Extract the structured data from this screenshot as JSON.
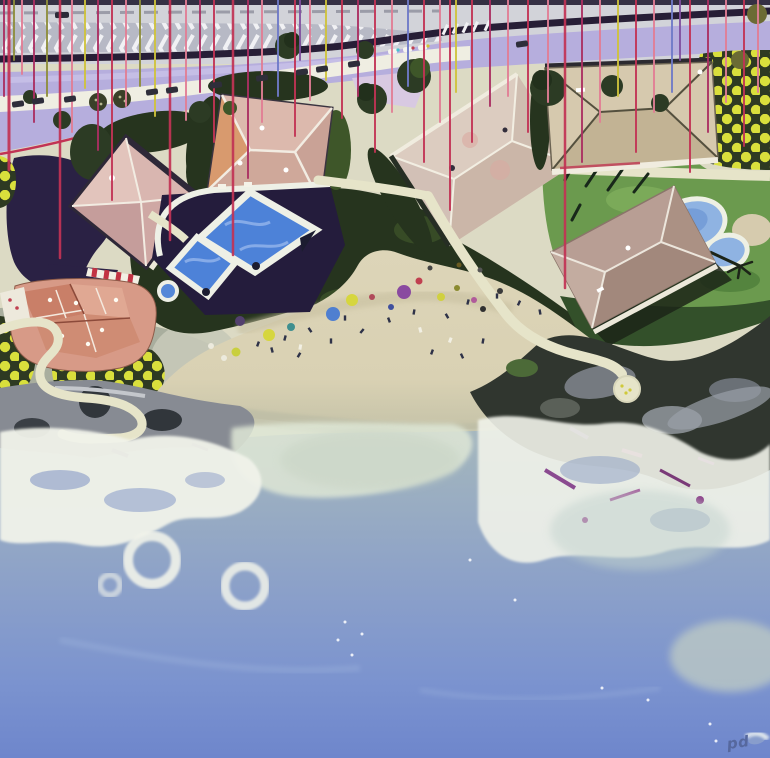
{
  "artwork": {
    "signature": "pd"
  },
  "palette": {
    "top_strip": "#353044",
    "road_gray": "#d2d3d9",
    "road_dash": "#9b9ca8",
    "chev_bg": "#b7b9c5",
    "chev_white": "#f1f1f4",
    "median_dark": "#271e36",
    "lavender": "#b6aedd",
    "lavender_light": "#c9c2e8",
    "lavender_pink": "#d8c9e2",
    "edge_crimson": "#c23355",
    "cream": "#e6e4c9",
    "cream_dark": "#d8d6ba",
    "parking_white": "#efeee2",
    "ground_olive": "#dcdac4",
    "tree_dark": "#26341e",
    "tree_mid": "#3e5629",
    "lawn": "#6b9a4e",
    "lawn_light": "#7fae5c",
    "polka_bg": "#2e3a22",
    "polka_dot": "#d9df3c",
    "deck_navy": "#241c3c",
    "navy_shadow": "#2a2144",
    "pool_blue": "#4d82d8",
    "pool_light": "#86abe8",
    "pool_rim": "#eef0e6",
    "kidney_blue": "#8fb3e2",
    "kidney_deep": "#6f98d6",
    "roofA": "#d9b6b0",
    "roofA_sh": "#c59d9b",
    "roofB": "#dcb9ad",
    "roofB_sh": "#cfa89a",
    "roofB_or": "#d89a6e",
    "roofC": "#d8c7bb",
    "roofC_sh": "#cbb6a8",
    "roofD": "#d6c9ae",
    "roofD_sh": "#c2b394",
    "roofE": "#b89e94",
    "roofE_sh": "#a2887c",
    "roofF": "#d79a87",
    "roofF_dk": "#c97f68",
    "sand": "#d9d1b3",
    "sand_wet": "#bdbda6",
    "rock_gray": "#878b93",
    "rock_dark": "#31363b",
    "cliff_dark": "#30362f",
    "cliff_gray": "#7d8289",
    "purple_accent": "#6a4a85",
    "magenta_accent": "#9c3f80",
    "ocean_top": "#b6c3bd",
    "ocean_mid": "#9fb2bf",
    "ocean_deep": "#7b93cf",
    "ocean_bottom": "#6e86cc",
    "foam_white": "#f1f3ea",
    "foam_soft": "#dfe7d6",
    "mint": "#c7d3c3",
    "teal_pale": "#c2d3cd",
    "signature_blue": "#56689e",
    "drip_crimson": "#c23355",
    "drip_pink": "#e27e95",
    "drip_magenta": "#ab2f62",
    "drip_yellow": "#cfc33c",
    "drip_olive": "#8e8e3c",
    "drip_blue": "#6f7ac8",
    "drip_violet": "#8050a0"
  },
  "scene": {
    "drips": [
      {
        "x": 4,
        "y1": 0,
        "y2": 96,
        "c": "drip_magenta",
        "w": 2
      },
      {
        "x": 9,
        "y1": 0,
        "y2": 170,
        "c": "drip_crimson",
        "w": 3
      },
      {
        "x": 14,
        "y1": 0,
        "y2": 60,
        "c": "drip_olive",
        "w": 2
      },
      {
        "x": 22,
        "y1": 0,
        "y2": 74,
        "c": "drip_pink",
        "w": 2
      },
      {
        "x": 34,
        "y1": 0,
        "y2": 122,
        "c": "drip_magenta",
        "w": 2
      },
      {
        "x": 47,
        "y1": 0,
        "y2": 96,
        "c": "drip_olive",
        "w": 2
      },
      {
        "x": 60,
        "y1": 0,
        "y2": 258,
        "c": "drip_crimson",
        "w": 2.5
      },
      {
        "x": 72,
        "y1": 0,
        "y2": 132,
        "c": "drip_pink",
        "w": 2
      },
      {
        "x": 85,
        "y1": 0,
        "y2": 88,
        "c": "drip_yellow",
        "w": 2
      },
      {
        "x": 98,
        "y1": 0,
        "y2": 150,
        "c": "drip_magenta",
        "w": 2
      },
      {
        "x": 112,
        "y1": 0,
        "y2": 200,
        "c": "drip_crimson",
        "w": 2
      },
      {
        "x": 126,
        "y1": 0,
        "y2": 106,
        "c": "drip_pink",
        "w": 2
      },
      {
        "x": 140,
        "y1": 0,
        "y2": 86,
        "c": "drip_olive",
        "w": 2
      },
      {
        "x": 155,
        "y1": 0,
        "y2": 116,
        "c": "drip_yellow",
        "w": 2
      },
      {
        "x": 170,
        "y1": 0,
        "y2": 240,
        "c": "drip_crimson",
        "w": 2.5
      },
      {
        "x": 186,
        "y1": 0,
        "y2": 120,
        "c": "drip_pink",
        "w": 2
      },
      {
        "x": 200,
        "y1": 0,
        "y2": 92,
        "c": "drip_magenta",
        "w": 2
      },
      {
        "x": 214,
        "y1": 0,
        "y2": 142,
        "c": "drip_crimson",
        "w": 2
      },
      {
        "x": 233,
        "y1": 0,
        "y2": 255,
        "c": "drip_crimson",
        "w": 2.5
      },
      {
        "x": 248,
        "y1": 0,
        "y2": 178,
        "c": "drip_magenta",
        "w": 2
      },
      {
        "x": 262,
        "y1": 0,
        "y2": 122,
        "c": "drip_pink",
        "w": 2
      },
      {
        "x": 278,
        "y1": 0,
        "y2": 96,
        "c": "drip_blue",
        "w": 2
      },
      {
        "x": 295,
        "y1": 0,
        "y2": 136,
        "c": "drip_crimson",
        "w": 2
      },
      {
        "x": 300,
        "y1": 0,
        "y2": 60,
        "c": "drip_violet",
        "w": 2
      },
      {
        "x": 310,
        "y1": 0,
        "y2": 100,
        "c": "drip_pink",
        "w": 2
      },
      {
        "x": 326,
        "y1": 0,
        "y2": 80,
        "c": "drip_yellow",
        "w": 2
      },
      {
        "x": 342,
        "y1": 0,
        "y2": 118,
        "c": "drip_crimson",
        "w": 2
      },
      {
        "x": 358,
        "y1": 0,
        "y2": 96,
        "c": "drip_magenta",
        "w": 2
      },
      {
        "x": 375,
        "y1": 0,
        "y2": 152,
        "c": "drip_crimson",
        "w": 2
      },
      {
        "x": 392,
        "y1": 0,
        "y2": 112,
        "c": "drip_pink",
        "w": 2
      },
      {
        "x": 408,
        "y1": 0,
        "y2": 86,
        "c": "drip_blue",
        "w": 2
      },
      {
        "x": 424,
        "y1": 0,
        "y2": 162,
        "c": "drip_crimson",
        "w": 2
      },
      {
        "x": 440,
        "y1": 0,
        "y2": 122,
        "c": "drip_pink",
        "w": 2
      },
      {
        "x": 450,
        "y1": 0,
        "y2": 210,
        "c": "drip_crimson",
        "w": 2
      },
      {
        "x": 456,
        "y1": 0,
        "y2": 92,
        "c": "drip_yellow",
        "w": 2
      },
      {
        "x": 472,
        "y1": 0,
        "y2": 142,
        "c": "drip_crimson",
        "w": 2
      },
      {
        "x": 490,
        "y1": 0,
        "y2": 106,
        "c": "drip_magenta",
        "w": 2
      },
      {
        "x": 508,
        "y1": 0,
        "y2": 96,
        "c": "drip_pink",
        "w": 2
      },
      {
        "x": 528,
        "y1": 0,
        "y2": 132,
        "c": "drip_crimson",
        "w": 2
      },
      {
        "x": 548,
        "y1": 0,
        "y2": 102,
        "c": "drip_pink",
        "w": 2
      },
      {
        "x": 565,
        "y1": 0,
        "y2": 288,
        "c": "drip_crimson",
        "w": 2.5
      },
      {
        "x": 582,
        "y1": 0,
        "y2": 162,
        "c": "drip_magenta",
        "w": 2
      },
      {
        "x": 600,
        "y1": 0,
        "y2": 122,
        "c": "drip_pink",
        "w": 2
      },
      {
        "x": 618,
        "y1": 0,
        "y2": 96,
        "c": "drip_yellow",
        "w": 2
      },
      {
        "x": 636,
        "y1": 0,
        "y2": 152,
        "c": "drip_crimson",
        "w": 2
      },
      {
        "x": 654,
        "y1": 0,
        "y2": 112,
        "c": "drip_pink",
        "w": 2
      },
      {
        "x": 672,
        "y1": 0,
        "y2": 92,
        "c": "drip_blue",
        "w": 2
      },
      {
        "x": 680,
        "y1": 0,
        "y2": 60,
        "c": "drip_violet",
        "w": 2
      },
      {
        "x": 690,
        "y1": 0,
        "y2": 172,
        "c": "drip_crimson",
        "w": 2
      },
      {
        "x": 708,
        "y1": 0,
        "y2": 132,
        "c": "drip_magenta",
        "w": 2
      },
      {
        "x": 726,
        "y1": 0,
        "y2": 102,
        "c": "drip_pink",
        "w": 2
      },
      {
        "x": 744,
        "y1": 0,
        "y2": 146,
        "c": "drip_crimson",
        "w": 2
      },
      {
        "x": 758,
        "y1": 0,
        "y2": 92,
        "c": "drip_pink",
        "w": 2
      }
    ],
    "umbrellas": [
      {
        "x": 352,
        "y": 300,
        "r": 6,
        "c": "#d6d63e"
      },
      {
        "x": 333,
        "y": 314,
        "r": 7,
        "c": "#4f7fd0"
      },
      {
        "x": 404,
        "y": 292,
        "r": 7,
        "c": "#8a4aa0"
      },
      {
        "x": 419,
        "y": 281,
        "r": 3.5,
        "c": "#c04050"
      },
      {
        "x": 269,
        "y": 335,
        "r": 6,
        "c": "#d6d63e"
      },
      {
        "x": 240,
        "y": 321,
        "r": 5,
        "c": "#53406e"
      },
      {
        "x": 291,
        "y": 327,
        "r": 4,
        "c": "#3f8f8f"
      },
      {
        "x": 372,
        "y": 297,
        "r": 3,
        "c": "#b04a5a"
      },
      {
        "x": 391,
        "y": 307,
        "r": 3,
        "c": "#40509e"
      },
      {
        "x": 441,
        "y": 297,
        "r": 4,
        "c": "#d0d040"
      },
      {
        "x": 457,
        "y": 288,
        "r": 3,
        "c": "#8a8a30"
      },
      {
        "x": 474,
        "y": 300,
        "r": 3,
        "c": "#b05a9a"
      },
      {
        "x": 236,
        "y": 352,
        "r": 4.5,
        "c": "#c9cf3e"
      },
      {
        "x": 211,
        "y": 346,
        "r": 3,
        "c": "#eceadd"
      },
      {
        "x": 224,
        "y": 358,
        "r": 3,
        "c": "#eceadd"
      },
      {
        "x": 500,
        "y": 291,
        "r": 3,
        "c": "#3a3a3a"
      },
      {
        "x": 483,
        "y": 309,
        "r": 3,
        "c": "#2f2f2f"
      },
      {
        "x": 459,
        "y": 265,
        "r": 2.5,
        "c": "#6a5a20"
      },
      {
        "x": 430,
        "y": 268,
        "r": 2.5,
        "c": "#444444"
      },
      {
        "x": 480,
        "y": 270,
        "r": 2.5,
        "c": "#555555"
      }
    ],
    "people": [
      {
        "x": 258,
        "y": 344,
        "a": 20
      },
      {
        "x": 272,
        "y": 350,
        "a": -15
      },
      {
        "x": 299,
        "y": 355,
        "a": 30
      },
      {
        "x": 331,
        "y": 341,
        "a": 0
      },
      {
        "x": 362,
        "y": 331,
        "a": 40
      },
      {
        "x": 389,
        "y": 320,
        "a": -20
      },
      {
        "x": 414,
        "y": 312,
        "a": 10
      },
      {
        "x": 447,
        "y": 316,
        "a": -30
      },
      {
        "x": 468,
        "y": 302,
        "a": 15
      },
      {
        "x": 497,
        "y": 296,
        "a": 0
      },
      {
        "x": 519,
        "y": 303,
        "a": 25
      },
      {
        "x": 540,
        "y": 312,
        "a": -10
      },
      {
        "x": 432,
        "y": 352,
        "a": 20
      },
      {
        "x": 462,
        "y": 356,
        "a": -25
      },
      {
        "x": 483,
        "y": 341,
        "a": 10
      },
      {
        "x": 310,
        "y": 330,
        "a": -35
      },
      {
        "x": 285,
        "y": 338,
        "a": 15
      },
      {
        "x": 345,
        "y": 318,
        "a": 0
      },
      {
        "x": 300,
        "y": 347,
        "a": 10,
        "t": "w"
      },
      {
        "x": 420,
        "y": 330,
        "a": -15,
        "t": "w"
      },
      {
        "x": 450,
        "y": 340,
        "a": 20,
        "t": "w"
      }
    ],
    "cars": [
      {
        "x": 18,
        "y": 104
      },
      {
        "x": 38,
        "y": 101
      },
      {
        "x": 70,
        "y": 99
      },
      {
        "x": 152,
        "y": 92
      },
      {
        "x": 172,
        "y": 90
      },
      {
        "x": 216,
        "y": 85
      },
      {
        "x": 262,
        "y": 78
      },
      {
        "x": 302,
        "y": 72
      },
      {
        "x": 322,
        "y": 69
      },
      {
        "x": 354,
        "y": 64
      },
      {
        "x": 522,
        "y": 44
      }
    ],
    "specks": [
      {
        "x": 345,
        "y": 622
      },
      {
        "x": 362,
        "y": 634
      },
      {
        "x": 352,
        "y": 655
      },
      {
        "x": 602,
        "y": 688
      },
      {
        "x": 648,
        "y": 700
      },
      {
        "x": 710,
        "y": 724
      },
      {
        "x": 716,
        "y": 741
      },
      {
        "x": 470,
        "y": 560
      },
      {
        "x": 515,
        "y": 600
      },
      {
        "x": 338,
        "y": 640
      }
    ]
  }
}
